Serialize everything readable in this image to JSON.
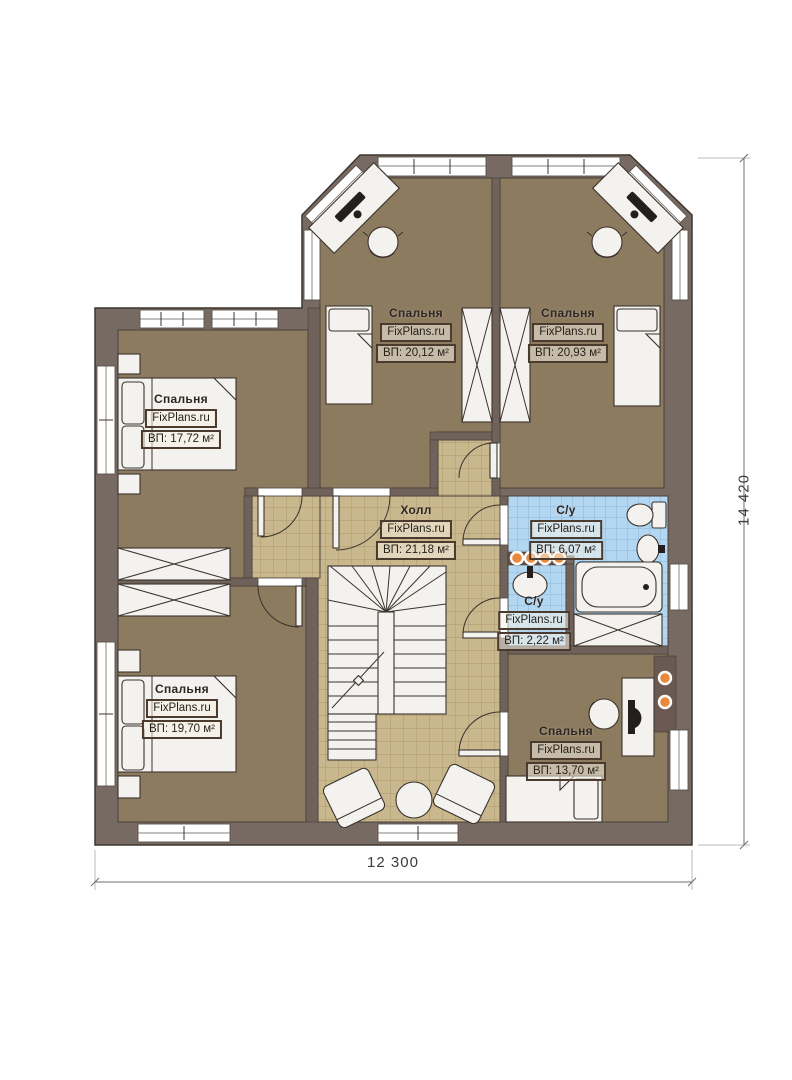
{
  "colors": {
    "wall": "#776a62",
    "wood": "#8d7b60",
    "furn": "#f4f2ee",
    "line": "#3a332d",
    "label-border": "#4a3b2e",
    "dim": "#6f6f6f",
    "light": "#e8893c",
    "page": "#ffffff"
  },
  "plan": {
    "watermark": "FixPlans.ru",
    "rooms": [
      {
        "id": "bedroom-top-left",
        "name": "Спальня",
        "area": "ВП: 20,12 м²"
      },
      {
        "id": "bedroom-top-right",
        "name": "Спальня",
        "area": "ВП: 20,93 м²"
      },
      {
        "id": "bedroom-left",
        "name": "Спальня",
        "area": "ВП: 17,72 м²"
      },
      {
        "id": "hall",
        "name": "Холл",
        "area": "ВП: 21,18 м²"
      },
      {
        "id": "bathroom-main",
        "name": "С/у",
        "area": "ВП: 6,07 м²"
      },
      {
        "id": "bathroom-small",
        "name": "С/у",
        "area": "ВП: 2,22 м²"
      },
      {
        "id": "bedroom-bottom-left",
        "name": "Спальня",
        "area": "ВП: 19,70 м²"
      },
      {
        "id": "bedroom-bottom-right",
        "name": "Спальня",
        "area": "ВП: 13,70 м²"
      }
    ],
    "dimensions": {
      "width_label": "12 300",
      "height_label": "14 420"
    }
  }
}
